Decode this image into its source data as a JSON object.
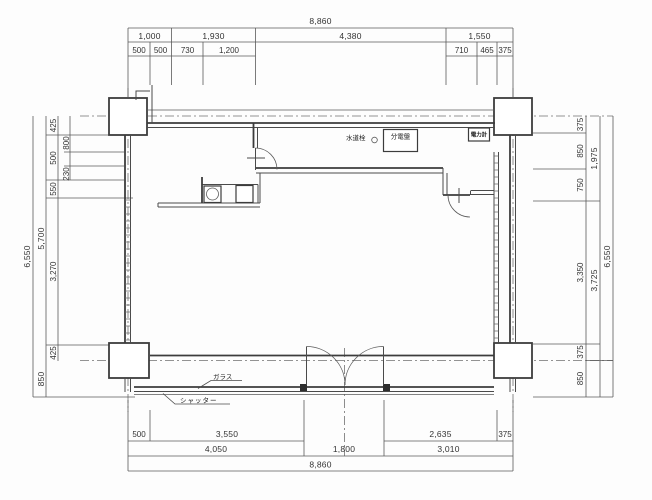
{
  "drawing": {
    "type": "floor-plan",
    "line_color": "#3c3c3c",
    "dim_line_color": "#5a5a5a",
    "background": "#fdfdfd"
  },
  "dims": {
    "top": {
      "overall": "8,860",
      "row2": [
        "1,000",
        "1,930",
        "4,380",
        "1,550"
      ],
      "row3": [
        "500",
        "500",
        "730",
        "1,200",
        "710",
        "465",
        "375"
      ]
    },
    "bottom": {
      "row1": [
        "500",
        "3,550",
        "2,635",
        "375"
      ],
      "row2": [
        "4,050",
        "1,800",
        "3,010"
      ],
      "overall": "8,860"
    },
    "left": {
      "overall": "6,550",
      "mid": [
        "5,700",
        "850"
      ],
      "chain": [
        "425",
        "500",
        "550",
        "3,270",
        "425"
      ],
      "sub": [
        "800",
        "230"
      ]
    },
    "right": {
      "overall": "6,550",
      "mid": [
        "1,975",
        "3,725"
      ],
      "chain": [
        "375",
        "850",
        "750",
        "3,350",
        "375",
        "850"
      ]
    }
  },
  "annotations": {
    "water_tap": "水道栓",
    "distribution_board": "分電盤",
    "power_meter": "電力計",
    "glass": "ガラス",
    "shutter": "シャッター"
  }
}
